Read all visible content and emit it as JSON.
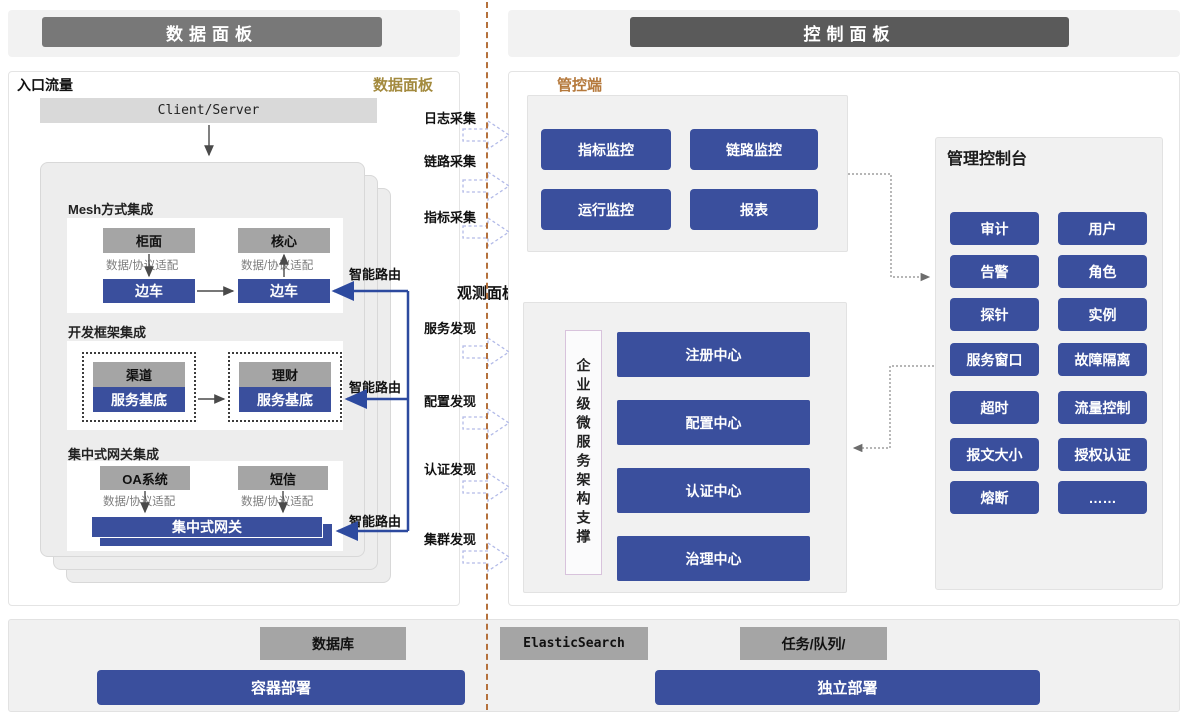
{
  "headers": {
    "left": "数据面板",
    "right": "控制面板"
  },
  "data_plane": {
    "corner_left": "入口流量",
    "corner_title": "数据面板",
    "entry_box": "Client/Server",
    "smart_route": "智能路由",
    "adapter": "数据/协议适配",
    "sections": {
      "mesh": {
        "title": "Mesh方式集成",
        "left_app": "柜面",
        "right_app": "核心",
        "left_sidecar": "边车",
        "right_sidecar": "边车"
      },
      "framework": {
        "title": "开发框架集成",
        "left_app": "渠道",
        "right_app": "理财",
        "left_base": "服务基底",
        "right_base": "服务基底"
      },
      "gateway": {
        "title": "集中式网关集成",
        "left_app": "OA系统",
        "right_app": "短信",
        "bar": "集中式网关"
      }
    }
  },
  "middle": {
    "collect": [
      "日志采集",
      "链路采集",
      "指标采集"
    ],
    "observe_title": "观测面板",
    "discover": [
      "服务发现",
      "配置发现",
      "认证发现",
      "集群发现"
    ]
  },
  "control_plane": {
    "corner_title": "管控端",
    "monitor_buttons": [
      "指标监控",
      "链路监控",
      "运行监控",
      "报表"
    ],
    "support_vertical": "企业级微服务架构支撑",
    "center_buttons": [
      "注册中心",
      "配置中心",
      "认证中心",
      "治理中心"
    ],
    "console": {
      "title": "管理控制台",
      "buttons": [
        "审计",
        "用户",
        "告警",
        "角色",
        "探针",
        "实例",
        "服务窗口",
        "故障隔离",
        "超时",
        "流量控制",
        "报文大小",
        "授权认证",
        "熔断",
        "……"
      ]
    }
  },
  "bottom": {
    "stores": [
      "数据库",
      "ElasticSearch",
      "任务/队列/"
    ],
    "deploy_left": "容器部署",
    "deploy_right": "独立部署"
  },
  "colors": {
    "accent_blue": "#3a4f9d",
    "header_gray_left": "#787878",
    "header_gray_right": "#5a5a5a",
    "box_gray": "#a5a5a5",
    "panel_gray": "#f1f1f1",
    "gold_label": "#a38a3e",
    "orange_label": "#b5793c",
    "divider_orange": "#b5713c",
    "dashed_arrow": "#b3bbe8"
  }
}
